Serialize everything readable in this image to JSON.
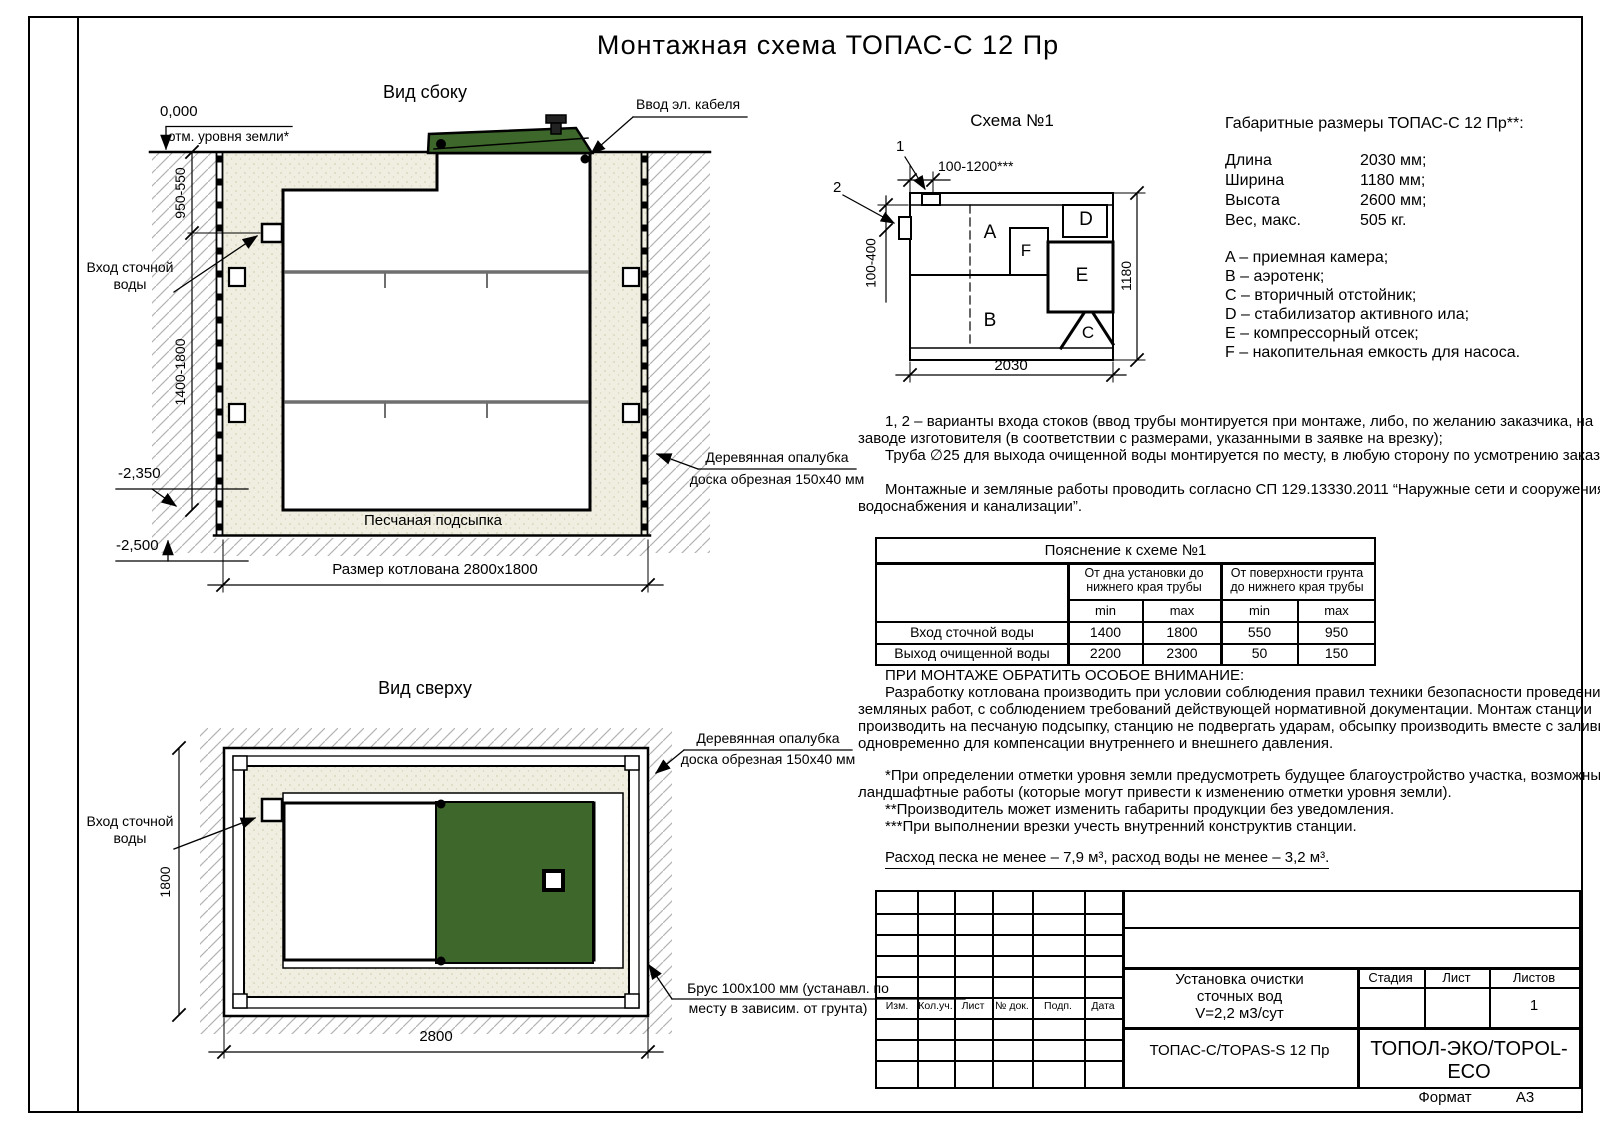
{
  "page": {
    "title": "Монтажная схема ТОПАС-С 12 Пр",
    "format_label": "Формат",
    "format_value": "А3"
  },
  "side_view": {
    "label": "Вид сбоку",
    "zero_mark": "0,000",
    "ground_note": "отм. уровня земли*",
    "cable_label": "Ввод эл. кабеля",
    "inlet_line1": "Вход сточной",
    "inlet_line2": "воды",
    "dim_upper": "950-550",
    "dim_lower": "1400-1800",
    "mark_bottom": "-2,350",
    "mark_pit": "-2,500",
    "sand_label": "Песчаная подсыпка",
    "pit_dim": "Размер котлована 2800х1800",
    "formwork_line1": "Деревянная опалубка",
    "formwork_line2": "доска обрезная 150х40 мм"
  },
  "top_view": {
    "label": "Вид сверху",
    "inlet_line1": "Вход сточной",
    "inlet_line2": "воды",
    "dim_width": "1800",
    "dim_length": "2800",
    "formwork_line1": "Деревянная опалубка",
    "formwork_line2": "доска обрезная 150х40 мм",
    "beam_line1": "Брус 100х100 мм (устанавл. по",
    "beam_line2": "месту в зависим. от грунта)"
  },
  "schema": {
    "title": "Схема №1",
    "callout_1": "1",
    "callout_2": "2",
    "dim_top": "100-1200***",
    "dim_left": "100-400",
    "dim_right": "1180",
    "dim_bottom": "2030",
    "comp_a": "A",
    "comp_b": "B",
    "comp_c": "C",
    "comp_d": "D",
    "comp_e": "E",
    "comp_f": "F"
  },
  "specs": {
    "heading": "Габаритные размеры ТОПАС-С 12 Пр**:",
    "rows": [
      {
        "label": "Длина",
        "value": "2030 мм;"
      },
      {
        "label": "Ширина",
        "value": "1180 мм;"
      },
      {
        "label": "Высота",
        "value": "2600 мм;"
      },
      {
        "label": "Вес, макс.",
        "value": "505 кг."
      }
    ],
    "legend": [
      "A – приемная камера;",
      "B – аэротенк;",
      "C – вторичный отстойник;",
      "D – стабилизатор активного ила;",
      "E – компрессорный отсек;",
      "F – накопительная емкость для насоса."
    ]
  },
  "notes": [
    "1, 2 – варианты входа стоков (ввод трубы монтируется при монтаже, либо, по желанию заказчика, на",
    "заводе изготовителя (в соответствии с размерами, указанными в заявке на врезку);",
    "Труба ∅25 для выхода очищенной воды монтируется по месту, в любую сторону по усмотрению заказчика.",
    "Монтажные и земляные работы проводить согласно СП 129.13330.2011 “Наружные сети и сооружения",
    "водоснабжения и канализации”."
  ],
  "table": {
    "title": "Пояснение к схеме №1",
    "group1": "От дна установки до нижнего края трубы",
    "group2": "От поверхности грунта до нижнего края трубы",
    "min": "min",
    "max": "max",
    "rows": [
      {
        "label": "Вход сточной воды",
        "v1": "1400",
        "v2": "1800",
        "v3": "550",
        "v4": "950"
      },
      {
        "label": "Выход очищенной воды",
        "v1": "2200",
        "v2": "2300",
        "v3": "50",
        "v4": "150"
      }
    ]
  },
  "attention": [
    "ПРИ МОНТАЖЕ ОБРАТИТЬ ОСОБОЕ ВНИМАНИЕ:",
    "Разработку котлована производить при условии соблюдения правил техники безопасности проведения",
    "земляных работ, с соблюдением требований действующей нормативной документации. Монтаж станции",
    "производить на песчаную подсыпку, станцию не подвергать ударам, обсыпку производить вместе с заливкой",
    "одновременно для компенсации внутреннего и внешнего давления."
  ],
  "footnotes": [
    "*При определении отметки уровня земли предусмотреть будущее благоустройство участка, возможные",
    "ландшафтные работы (которые могут привести к изменению отметки уровня земли).",
    "**Производитель может изменить габариты продукции без уведомления.",
    "***При выполнении врезки учесть внутренний конструктив станции."
  ],
  "consumption": "Расход песка не менее – 7,9 м³, расход воды не менее – 3,2 м³.",
  "title_block": {
    "cols": [
      "Изм.",
      "Кол.уч.",
      "Лист",
      "№ док.",
      "Подп.",
      "Дата"
    ],
    "doc_line1": "Установка очистки",
    "doc_line2": "сточных вод",
    "doc_line3": "V=2,2 м3/сут",
    "stage_label": "Стадия",
    "sheet_label": "Лист",
    "sheets_label": "Листов",
    "sheets_value": "1",
    "model": "ТОПАС-С/TOPAS-S 12 Пр",
    "company": "ТОПОЛ-ЭКО/TOPOL-ECO"
  },
  "colors": {
    "lid_green": "#3e672c",
    "sand": "#efeee0",
    "hatch": "#b3b3b3"
  }
}
